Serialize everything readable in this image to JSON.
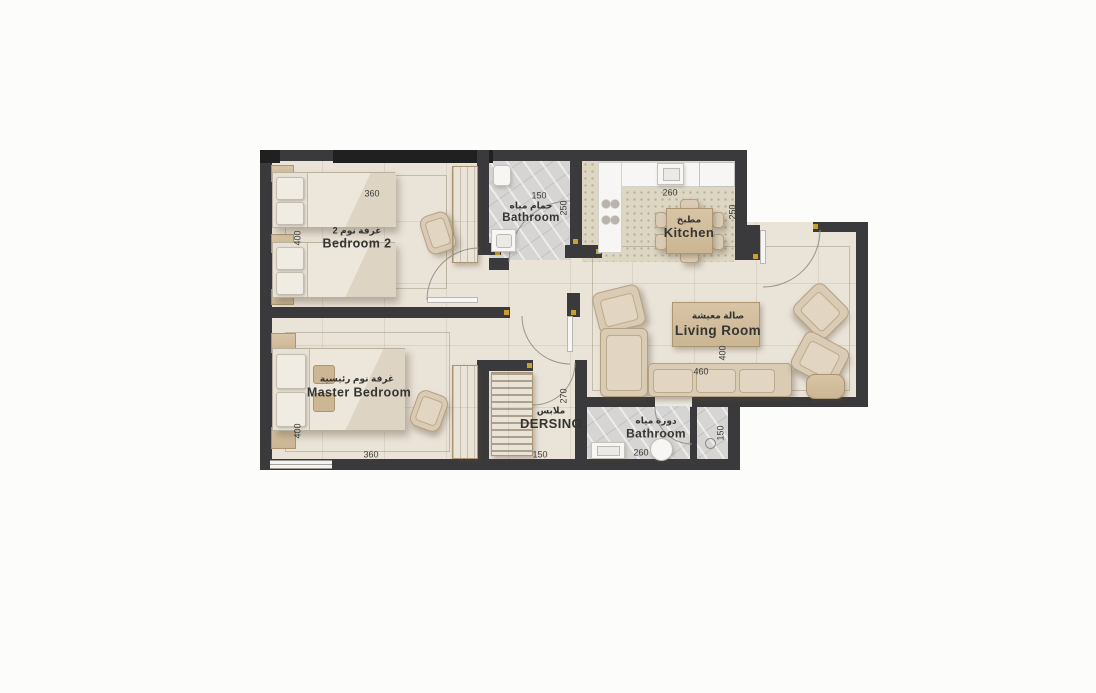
{
  "plan": {
    "title": "apartment-floor-plan",
    "colors": {
      "wall": "#3a393b",
      "floor": "#eae3d7",
      "marble": "#d6d5d3",
      "kitchen_floor": "#ddd6c3",
      "wood": "#d3bf9f",
      "fabric": "#d9cbb4",
      "marker": "#c8a12c"
    },
    "rooms": {
      "bedroom2": {
        "name_ar": "غرفة نوم 2",
        "name_en": "Bedroom 2",
        "dim_width": "360",
        "dim_depth": "400"
      },
      "bathroom_top": {
        "name_ar": "حمام مياه",
        "name_en": "Bathroom",
        "dim_width": "150",
        "dim_depth": "250"
      },
      "kitchen": {
        "name_ar": "مطبخ",
        "name_en": "Kitchen",
        "dim_width": "260",
        "dim_depth": "250"
      },
      "living_room": {
        "name_ar": "صالة معيشة",
        "name_en": "Living Room",
        "dim_width": "460",
        "dim_depth": "400"
      },
      "master_bedroom": {
        "name_ar": "غرفة نوم رئيسية",
        "name_en": "Master Bedroom",
        "dim_width": "360",
        "dim_depth": "400"
      },
      "dressing": {
        "name_ar": "ملابس",
        "name_en": "DERSING",
        "dim_width": "150",
        "dim_depth": "270"
      },
      "bathroom_bottom": {
        "name_ar": "دورة مياه",
        "name_en": "Bathroom",
        "dim_width": "260",
        "dim_depth": "150"
      }
    }
  }
}
